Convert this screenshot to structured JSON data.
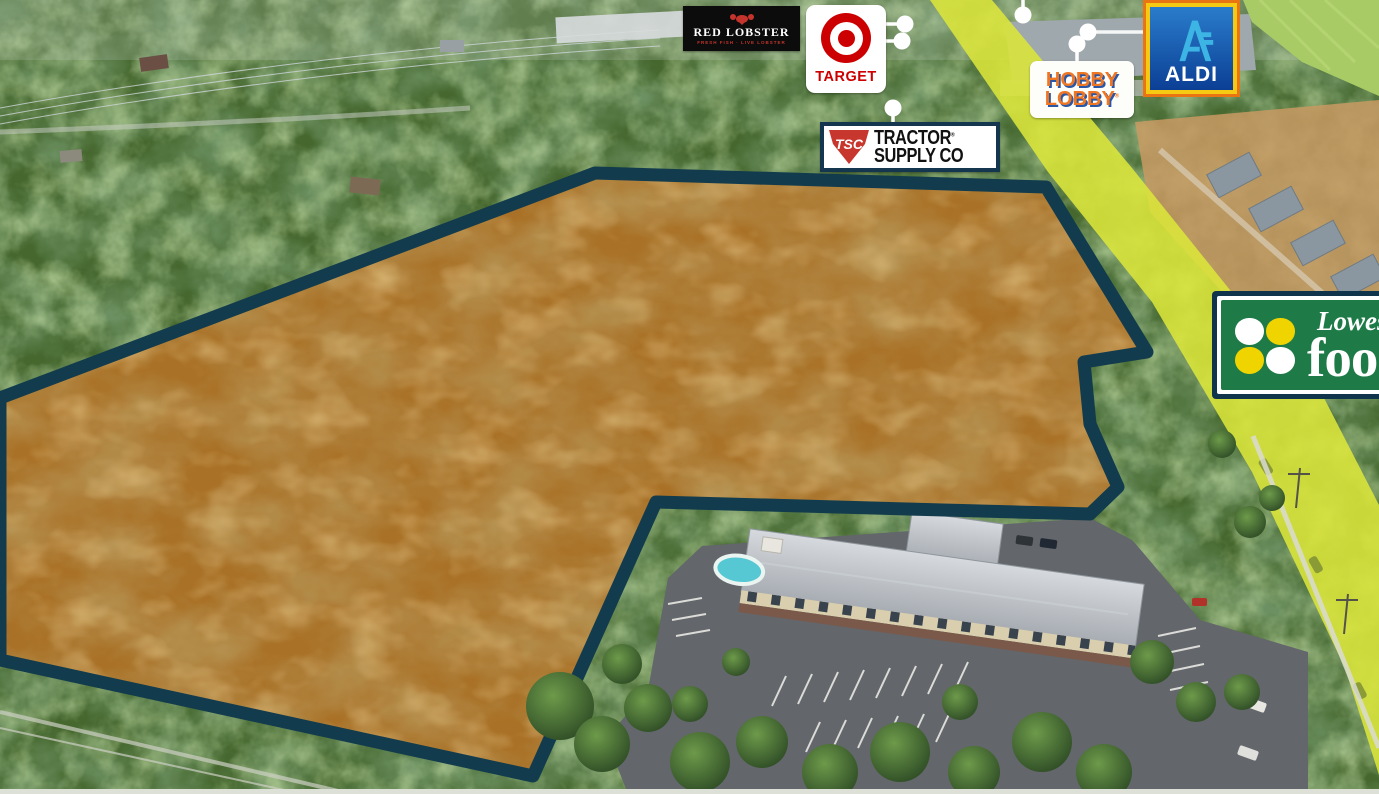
{
  "image": {
    "kind": "aerial-site-map",
    "width": 1379,
    "height": 794
  },
  "parcel": {
    "fill_color": "#a97127",
    "outline_color": "#123c4e"
  },
  "road": {
    "highlight_color": "#dce63a"
  },
  "map_markers": {
    "style": "white dot with white stem",
    "count": 6
  },
  "retailers": [
    {
      "id": "red-lobster",
      "name": "Red Lobster",
      "wordmark": "RED LOBSTER",
      "tagline": "FRESH FISH · LIVE LOBSTER",
      "bg": "#0c0c0c",
      "accent": "#c5342c"
    },
    {
      "id": "target",
      "name": "Target",
      "wordmark": "TARGET",
      "bg": "#ffffff",
      "accent": "#cc0000"
    },
    {
      "id": "tractor-supply",
      "name": "Tractor Supply Co",
      "shield_text": "TSC",
      "wordmark_line1": "TRACTOR",
      "wordmark_line2": "SUPPLY CO",
      "reg_mark": "®",
      "accent": "#c8372d",
      "border": "#14364e"
    },
    {
      "id": "hobby-lobby",
      "name": "Hobby Lobby",
      "wordmark_line1": "HOBBY",
      "wordmark_line2": "LOBBY",
      "reg_mark": "®",
      "accent": "#ef7622",
      "shadow": "#2a56a5"
    },
    {
      "id": "aldi",
      "name": "ALDI",
      "wordmark": "ALDI",
      "bg": "#1b66b5",
      "accent": "#3cb5e5",
      "frame_outer": "#e87511",
      "frame_inner": "#f6c913"
    },
    {
      "id": "lowes-foods",
      "name": "Lowes Foods",
      "wordmark_line1": "Lowes",
      "wordmark_line2": "foods",
      "bg": "#1e7b48",
      "apple_yellow": "#f0d400",
      "apple_white": "#ffffff",
      "border": "#10344c"
    }
  ]
}
